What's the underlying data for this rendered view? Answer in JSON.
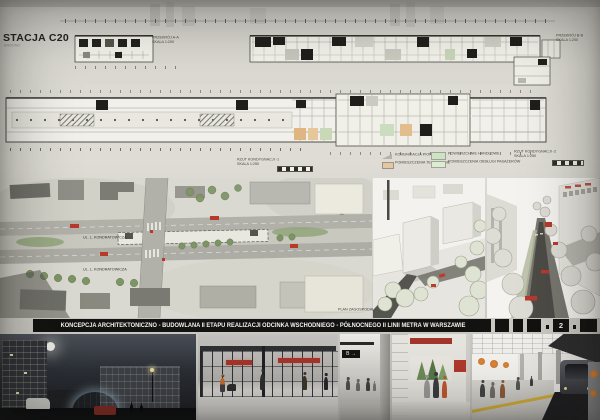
{
  "board": {
    "station_label": "STACJA C20",
    "station_sublabel": "BRÓDNO",
    "title_banner": "KONCEPCJA ARCHITEKTONICZNO - BUDOWLANA II ETAPU REALIZACJI ODCINKA WSCHODNIEGO - PÓŁNOCNEGO II LINII METRA W WARSZAWIE",
    "page_number": "2"
  },
  "plans": {
    "section_label": [
      "PRZEKRÓJ A-A",
      "SKALA 1:200"
    ],
    "section_right_label": [
      "PRZEKRÓJ B-B",
      "SKALA 1:200"
    ],
    "level_minus1_label": [
      "RZUT KONDYGNACJI -1",
      "SKALA 1:250"
    ],
    "level_minus2_label": [
      "RZUT KONDYGNACJI -2",
      "SKALA 1:250"
    ],
    "legend": [
      {
        "color": "#b4b3aa",
        "label": "KOMUNIKACJA PIONOWA"
      },
      {
        "color": "#e2c7a0",
        "label": "POMIESZCZENIA TECHNICZNE"
      },
      {
        "color": "#cfe2c6",
        "label": "POWIERZCHNIE HANDLOWE"
      },
      {
        "color": "#dcebd2",
        "label": "POMIESZCZENIA OBSŁUGI PASAŻERÓW"
      }
    ]
  },
  "site_plan": {
    "street_label_1": "UL. L. KONDRATOWICZA",
    "street_label_2": "UL. L. KONDRATOWICZA",
    "caption": "PLAN ZAGOSPODAROWANIA TERENU  SKALA 1:500"
  },
  "renders": {
    "passage_sign": "B →"
  },
  "colors": {
    "banner_bg": "#121211",
    "accent_red": "#b0392c",
    "accent_orange": "#d4752e",
    "tree_green": "#7d9465",
    "warning_yellow": "#d3ac39"
  }
}
